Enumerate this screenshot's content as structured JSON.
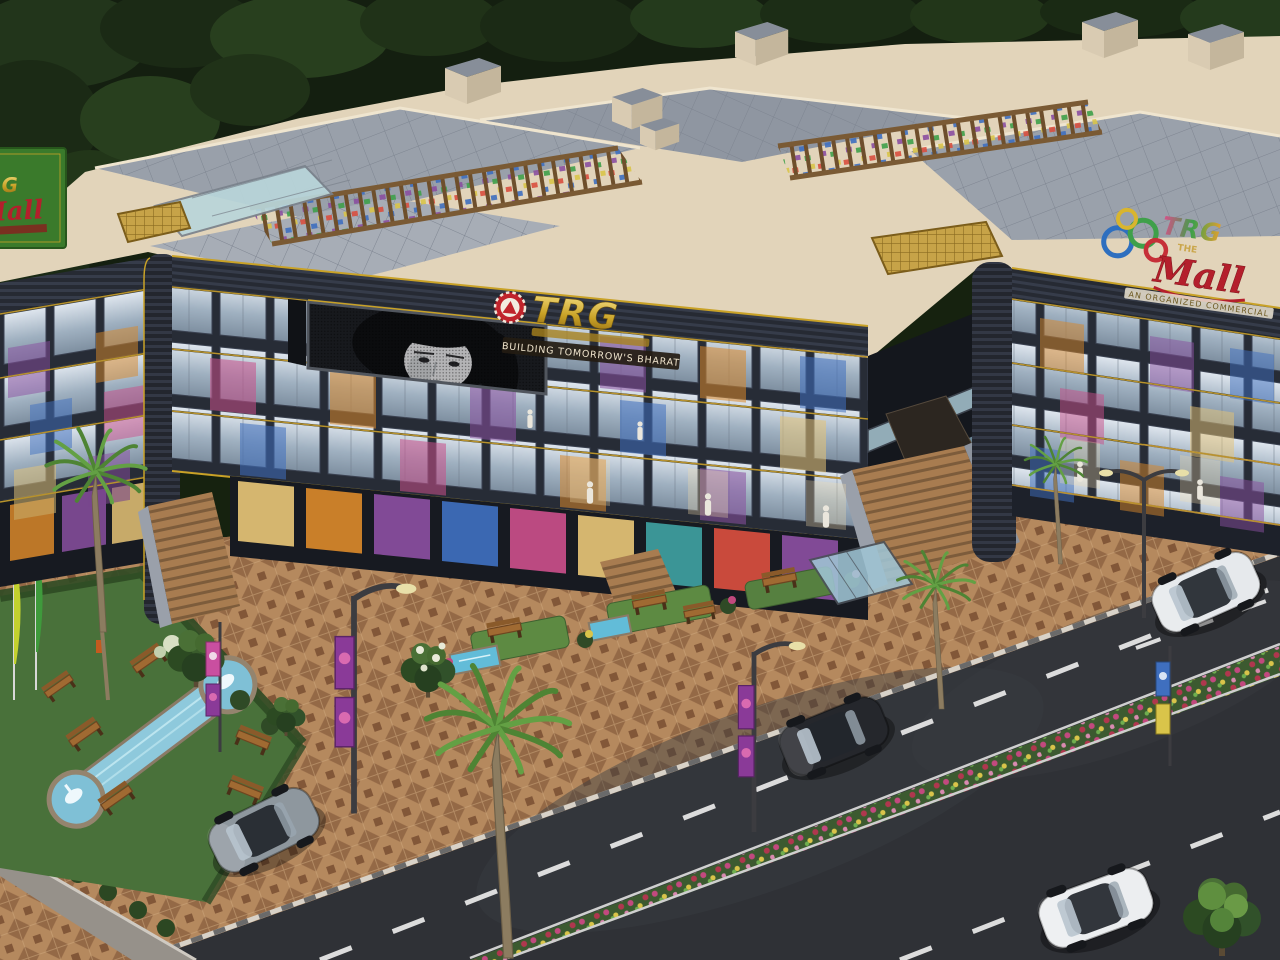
{
  "meta": {
    "title": "TRG Mall — aerial 3D architectural render",
    "scene": "Aerial dusk view of a three-storey organized commercial mall with glass shopfronts, rooftop pergola terrace, landscaped fountain garden, paved plaza and a front road with traffic",
    "style": "photorealistic exterior render"
  },
  "branding": {
    "developer_sign": {
      "brand": "TRG",
      "tagline": "BUILDING TOMORROW'S BHARAT",
      "emblem": "red rosette badge with white triangle",
      "gold": "#c9a227",
      "red": "#c0242c"
    },
    "mall_sign": {
      "brand": "TRG",
      "the": "THE",
      "name": "Mall",
      "subtitle": "AN ORGANIZED COMMERCIAL",
      "ring_colors": [
        "#2e6fbf",
        "#3fa04a",
        "#d9b52e",
        "#c62f38"
      ]
    },
    "left_sign": {
      "brand": "TRG",
      "name": "Mall"
    }
  },
  "building": {
    "glass_storefront_floors": 3,
    "billboard": "curved corner LED screen with black-and-white woman portrait",
    "features": [
      "dark curved fascia with gold trim lines",
      "rooftop wooden pergola terrace with colorful seating",
      "grand central entry staircase",
      "basement ramp entry",
      "glass bridge and escalator block",
      "gold slatted entrance canopies",
      "mannequin shop windows with colorful displays"
    ]
  },
  "street": {
    "cars": [
      {
        "type": "suv",
        "color": "white",
        "position": "upper-right"
      },
      {
        "type": "suv",
        "color": "black",
        "position": "center"
      },
      {
        "type": "sedan",
        "color": "grey",
        "position": "lower-left"
      },
      {
        "type": "sedan",
        "color": "white",
        "position": "lower-right"
      }
    ],
    "markings": "dashed white lane lines",
    "median": "flowering plant median strip",
    "curb": "striped white-grey curb"
  },
  "landscape": {
    "palm_trees": 4,
    "deciduous_trees": 4,
    "garden_benches": 6,
    "fountain": "twin circular fountains joined by a water channel",
    "flags": [
      "yellow-green",
      "green"
    ],
    "street_lights": 3,
    "banner_poles": 2,
    "lawn": "#49713a"
  },
  "palette": {
    "roof_beige": "#e2d4ba",
    "roof_grey": "#99a0aa",
    "fascia_dark": "#262a33",
    "gold_trim": "#c9a227",
    "glass": "#b9c8d6",
    "plaza_tan": "#b5895e",
    "road": "#2f3136",
    "water": "#7fc0d6"
  }
}
